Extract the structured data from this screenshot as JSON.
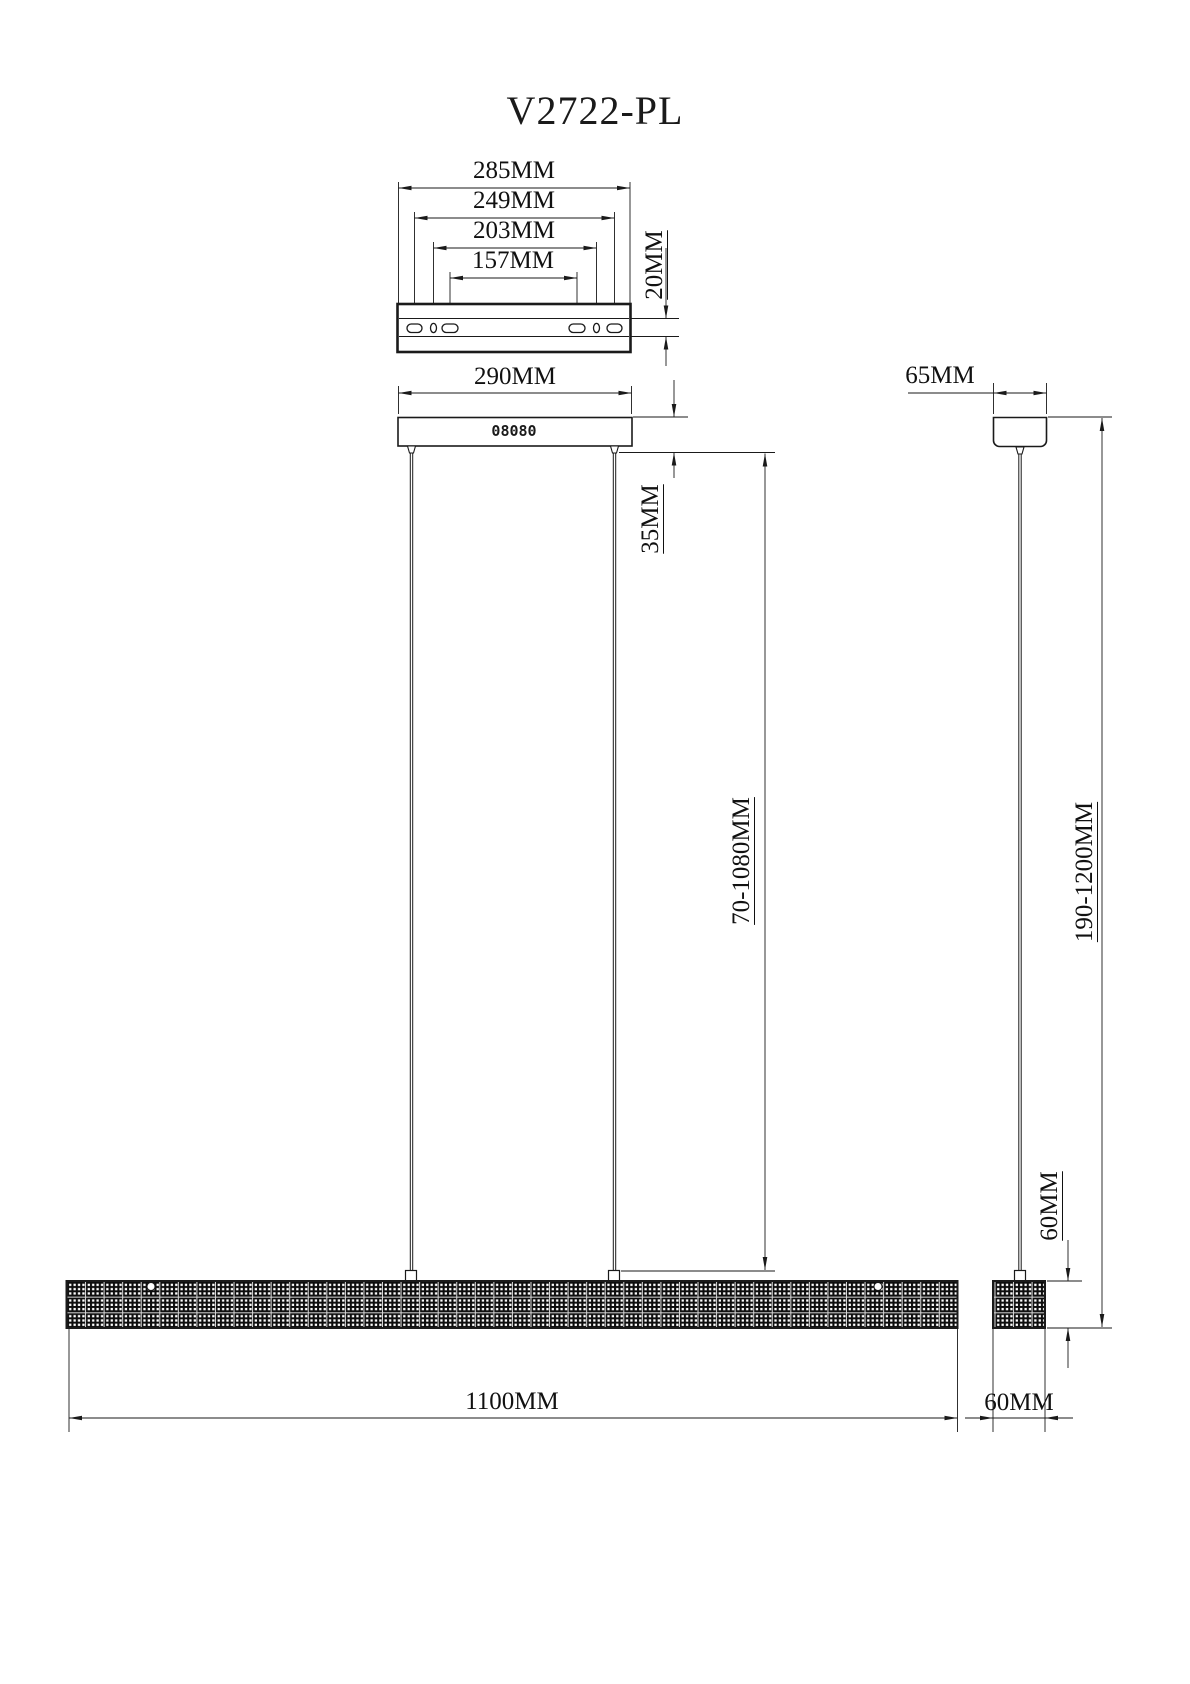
{
  "title": "V2722-PL",
  "top_view": {
    "width_285": "285MM",
    "width_249": "249MM",
    "width_203": "203MM",
    "width_157": "157MM",
    "height_20": "20MM"
  },
  "front_view": {
    "canopy_width": "290MM",
    "canopy_drop": "35MM",
    "cable_range": "70-1080MM",
    "bar_length": "1100MM",
    "canopy_marks": "08080"
  },
  "side_view": {
    "canopy_width": "65MM",
    "total_range": "190-1200MM",
    "bar_height": "60MM",
    "bar_width": "60MM"
  },
  "colors": {
    "line": "#1a1a1a",
    "background": "#ffffff",
    "bar_fill": "#0d0d0d",
    "bar_dots": "#ffffff",
    "bar_grid": "#d9d9d9"
  }
}
